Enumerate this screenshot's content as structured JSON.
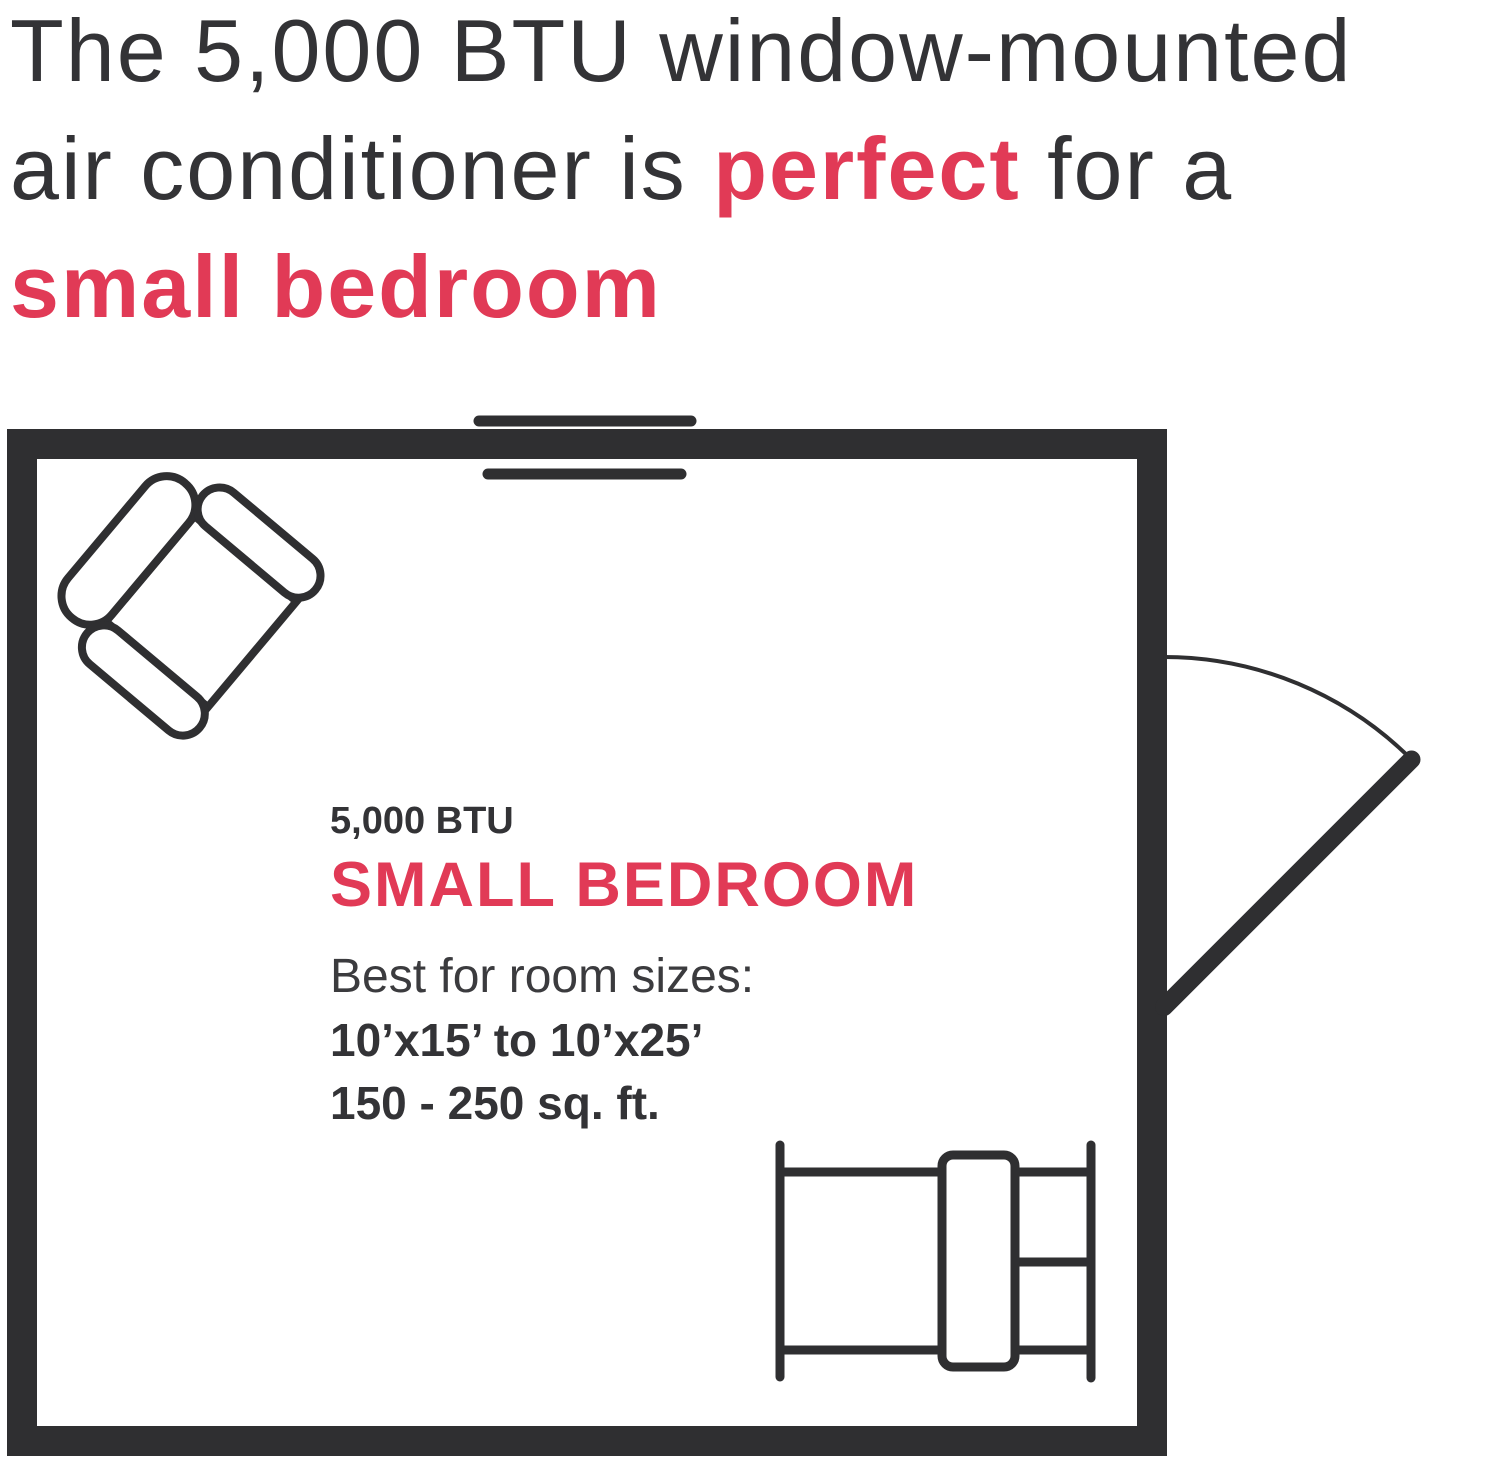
{
  "headline": {
    "line1": "The 5,000 BTU window-mounted",
    "line2_pre": "air conditioner is ",
    "line2_highlight": "perfect",
    "line2_post": " for a",
    "line3_highlight": "small bedroom"
  },
  "floorplan": {
    "btu_label": "5,000 BTU",
    "room_type": "SMALL BEDROOM",
    "fit_line": "Best for room sizes:",
    "dimensions_range": "10’x15’ to 10’x25’",
    "area_range": "150 - 250 sq. ft."
  },
  "icons": {
    "window_ac": "window-ac-icon",
    "armchair": "armchair-icon",
    "door": "door-swing-icon",
    "bed": "bed-icon"
  },
  "colors": {
    "ink": "#2f2f31",
    "accent_red": "#e13a56",
    "headline_text": "#333336",
    "background": "#ffffff"
  }
}
